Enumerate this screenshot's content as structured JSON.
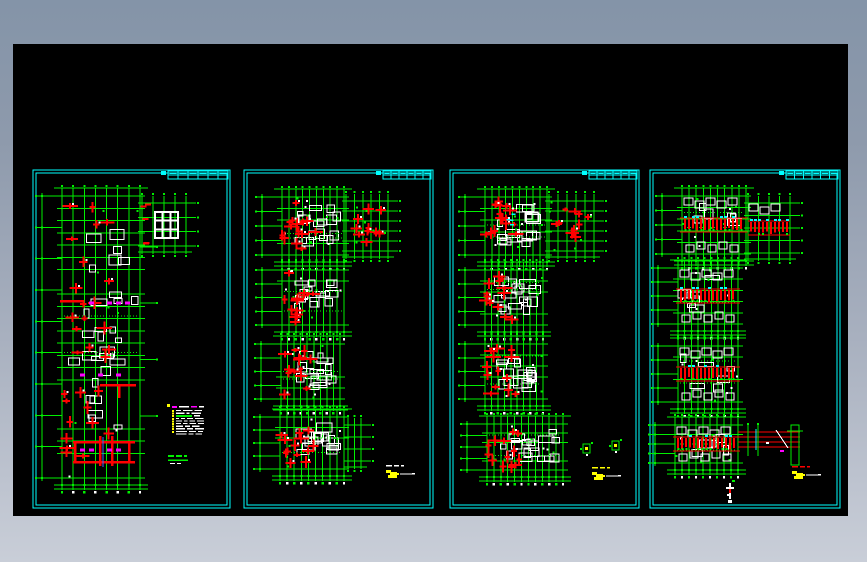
{
  "page": {
    "bg_top": "#8494a8",
    "bg_bottom": "#c9ced8",
    "width": 867,
    "height": 562
  },
  "canvas": {
    "x": 13,
    "y": 44,
    "w": 835,
    "h": 472,
    "bg": "#000000"
  },
  "palette": {
    "cyan": "#00ffff",
    "green": "#00f000",
    "red": "#ff0000",
    "yellow": "#ffff00",
    "white": "#ffffff",
    "magenta": "#ff00ff",
    "blue": "#3b6cff",
    "black": "#000000"
  },
  "sheets": [
    {
      "name": "sheet-1",
      "x": 33,
      "y": 170,
      "w": 197,
      "h": 338,
      "strip": 60,
      "strip_cols": 6,
      "plans": [
        {
          "seed": 11,
          "x": 62,
          "y": 196,
          "w": 78,
          "h": 282,
          "cols": 7,
          "rows": 23,
          "white": 30,
          "red": "clusters",
          "redCount": 30,
          "redArea": [
            0.0,
            0.02,
            0.62,
            0.95
          ],
          "dims": "both",
          "leftN": 9,
          "beams": [
            [
              73,
              441,
              62,
              2.5
            ],
            [
              73,
              461,
              62,
              2.5
            ],
            [
              74,
              441,
              2.5,
              22
            ],
            [
              99,
              436,
              2.5,
              30
            ],
            [
              111,
              436,
              2.5,
              30
            ],
            [
              128,
              441,
              2.5,
              22
            ],
            [
              100,
              384,
              36,
              2.5
            ],
            [
              60,
              300,
              24,
              2.5
            ],
            [
              118,
              384,
              2.5,
              14
            ]
          ],
          "magentaRows": [
            0.38,
            0.635,
            0.9
          ],
          "blueV": {
            "x": 103,
            "y": 437,
            "h": 30
          },
          "ext": {
            "x": 142,
            "y": 203,
            "w": 44,
            "h": 43,
            "cols": 4,
            "rows": 3,
            "style": "whiteGrid",
            "wg": [
              155,
              212,
              23,
              26
            ]
          }
        }
      ],
      "details": [
        {
          "type": "noteBlock",
          "x": 172,
          "y": 406,
          "w": 34,
          "h": 30,
          "lines": 10
        },
        {
          "type": "titleLabel",
          "x": 168,
          "y": 455
        },
        {
          "type": "yellowTick",
          "x": 170,
          "y": 406
        }
      ]
    },
    {
      "name": "sheet-2",
      "x": 244,
      "y": 170,
      "w": 189,
      "h": 338,
      "strip": 48,
      "strip_cols": 6,
      "plans": [
        {
          "seed": 21,
          "x": 282,
          "y": 197,
          "w": 62,
          "h": 58,
          "cols": 9,
          "rows": 5,
          "white": 16,
          "roomBias": true,
          "red": "clusters",
          "redCount": 14,
          "redArea": [
            0.0,
            0.05,
            0.55,
            0.9
          ],
          "dims": "left",
          "leftN": 4,
          "ext": {
            "x": 346,
            "y": 201,
            "w": 42,
            "h": 50,
            "cols": 5,
            "rows": 5,
            "style": "redClusters"
          }
        },
        {
          "seed": 22,
          "x": 282,
          "y": 270,
          "w": 62,
          "h": 55,
          "cols": 9,
          "rows": 5,
          "white": 15,
          "roomBias": true,
          "red": "clusters",
          "redCount": 12,
          "redArea": [
            0.0,
            0.05,
            0.5,
            0.9
          ],
          "dims": "left",
          "leftN": 4
        },
        {
          "seed": 23,
          "x": 281,
          "y": 344,
          "w": 59,
          "h": 55,
          "cols": 9,
          "rows": 5,
          "white": 15,
          "roomBias": true,
          "red": "clusters",
          "redCount": 13,
          "redArea": [
            0.0,
            0.05,
            0.55,
            0.9
          ],
          "dims": "left",
          "leftN": 4
        },
        {
          "seed": 24,
          "x": 280,
          "y": 417,
          "w": 64,
          "h": 52,
          "cols": 9,
          "rows": 5,
          "white": 15,
          "roomBias": true,
          "red": "clusters",
          "redCount": 13,
          "redArea": [
            0.0,
            0.05,
            0.55,
            0.9
          ],
          "dims": "left",
          "leftN": 4,
          "ext": {
            "x": 348,
            "y": 425,
            "w": 13,
            "h": 36,
            "cols": 2,
            "rows": 3,
            "style": "plain"
          }
        }
      ],
      "details": [
        {
          "type": "yellowNote",
          "x": 386,
          "y": 470,
          "top": "white"
        }
      ]
    },
    {
      "name": "sheet-3",
      "x": 450,
      "y": 170,
      "w": 189,
      "h": 338,
      "strip": 48,
      "strip_cols": 6,
      "plans": [
        {
          "seed": 31,
          "x": 485,
          "y": 197,
          "w": 62,
          "h": 58,
          "cols": 9,
          "rows": 5,
          "white": 16,
          "roomBias": true,
          "red": "clusters",
          "redCount": 16,
          "redArea": [
            0.0,
            0.05,
            0.6,
            0.9
          ],
          "cyanMarks": true,
          "dims": "left",
          "leftN": 4,
          "ext": {
            "x": 549,
            "y": 201,
            "w": 45,
            "h": 50,
            "cols": 5,
            "rows": 5,
            "style": "redClusters"
          }
        },
        {
          "seed": 32,
          "x": 485,
          "y": 270,
          "w": 58,
          "h": 55,
          "cols": 9,
          "rows": 5,
          "white": 15,
          "roomBias": true,
          "red": "clusters",
          "redCount": 13,
          "redArea": [
            0.0,
            0.05,
            0.55,
            0.9
          ],
          "dims": "left",
          "leftN": 4
        },
        {
          "seed": 33,
          "x": 485,
          "y": 344,
          "w": 58,
          "h": 55,
          "cols": 9,
          "rows": 5,
          "white": 15,
          "roomBias": true,
          "red": "clusters",
          "redCount": 13,
          "redArea": [
            0.0,
            0.05,
            0.55,
            0.9
          ],
          "dims": "left",
          "leftN": 4
        },
        {
          "seed": 34,
          "x": 487,
          "y": 424,
          "w": 76,
          "h": 46,
          "cols": 11,
          "rows": 5,
          "white": 17,
          "roomBias": true,
          "red": "clusters",
          "redCount": 13,
          "redArea": [
            0.0,
            0.05,
            0.45,
            0.9
          ],
          "dims": "left",
          "leftN": 4
        }
      ],
      "details": [
        {
          "type": "greenDetail",
          "x": 583,
          "y": 444
        },
        {
          "type": "greenDetail",
          "x": 612,
          "y": 441
        },
        {
          "type": "yellowNote",
          "x": 592,
          "y": 472,
          "top": "yellow"
        }
      ]
    },
    {
      "name": "sheet-4",
      "x": 650,
      "y": 170,
      "w": 190,
      "h": 338,
      "strip": 52,
      "strip_cols": 6,
      "plans": [
        {
          "seed": 41,
          "x": 682,
          "y": 196,
          "w": 64,
          "h": 58,
          "cols": 9,
          "rows": 5,
          "white": 6,
          "red": "band",
          "dims": "left",
          "leftN": 4,
          "ext": {
            "x": 748,
            "y": 203,
            "w": 42,
            "h": 50,
            "cols": 4,
            "rows": 4,
            "style": "redBand"
          }
        },
        {
          "seed": 42,
          "x": 678,
          "y": 268,
          "w": 60,
          "h": 56,
          "cols": 9,
          "rows": 5,
          "white": 6,
          "red": "band",
          "dims": "left",
          "leftN": 4
        },
        {
          "seed": 43,
          "x": 678,
          "y": 346,
          "w": 60,
          "h": 56,
          "cols": 9,
          "rows": 5,
          "white": 6,
          "red": "band",
          "dims": "left",
          "leftN": 4
        },
        {
          "seed": 44,
          "x": 675,
          "y": 425,
          "w": 63,
          "h": 38,
          "cols": 9,
          "rows": 4,
          "white": 5,
          "red": "band",
          "dims": "left",
          "leftN": 4
        }
      ],
      "details": [
        {
          "type": "redLines",
          "x": 738,
          "y": 432,
          "x2": 800,
          "cyanX": 756,
          "greens": [
            748,
            758
          ],
          "frame": [
            791,
            425,
            8,
            40
          ]
        },
        {
          "type": "yellowNote",
          "x": 792,
          "y": 471,
          "top": "red"
        },
        {
          "type": "whiteCross",
          "x": 726,
          "y": 483
        }
      ]
    }
  ]
}
